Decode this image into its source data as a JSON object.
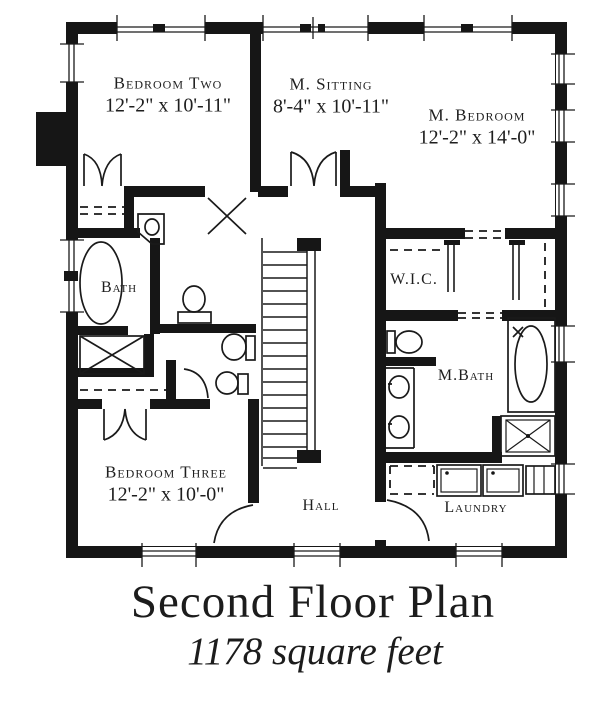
{
  "page": {
    "background": "#ffffff",
    "ink": "#1a1a1a"
  },
  "plan": {
    "rooms": {
      "bedroom_two": {
        "name": "Bedroom Two",
        "dims": "12'-2\" x 10'-11\""
      },
      "m_sitting": {
        "name": "M. Sitting",
        "dims": "8'-4\" x 10'-11\""
      },
      "m_bedroom": {
        "name": "M. Bedroom",
        "dims": "12'-2\" x 14'-0\""
      },
      "bath": {
        "name": "Bath"
      },
      "wic": {
        "name": "W.I.C."
      },
      "m_bath": {
        "name": "M.Bath"
      },
      "bedroom_three": {
        "name": "Bedroom Three",
        "dims": "12'-2\" x 10'-0\""
      },
      "hall": {
        "name": "Hall"
      },
      "laundry": {
        "name": "Laundry"
      }
    }
  },
  "title": {
    "text": "Second Floor Plan",
    "subtitle": "1178 square feet"
  }
}
